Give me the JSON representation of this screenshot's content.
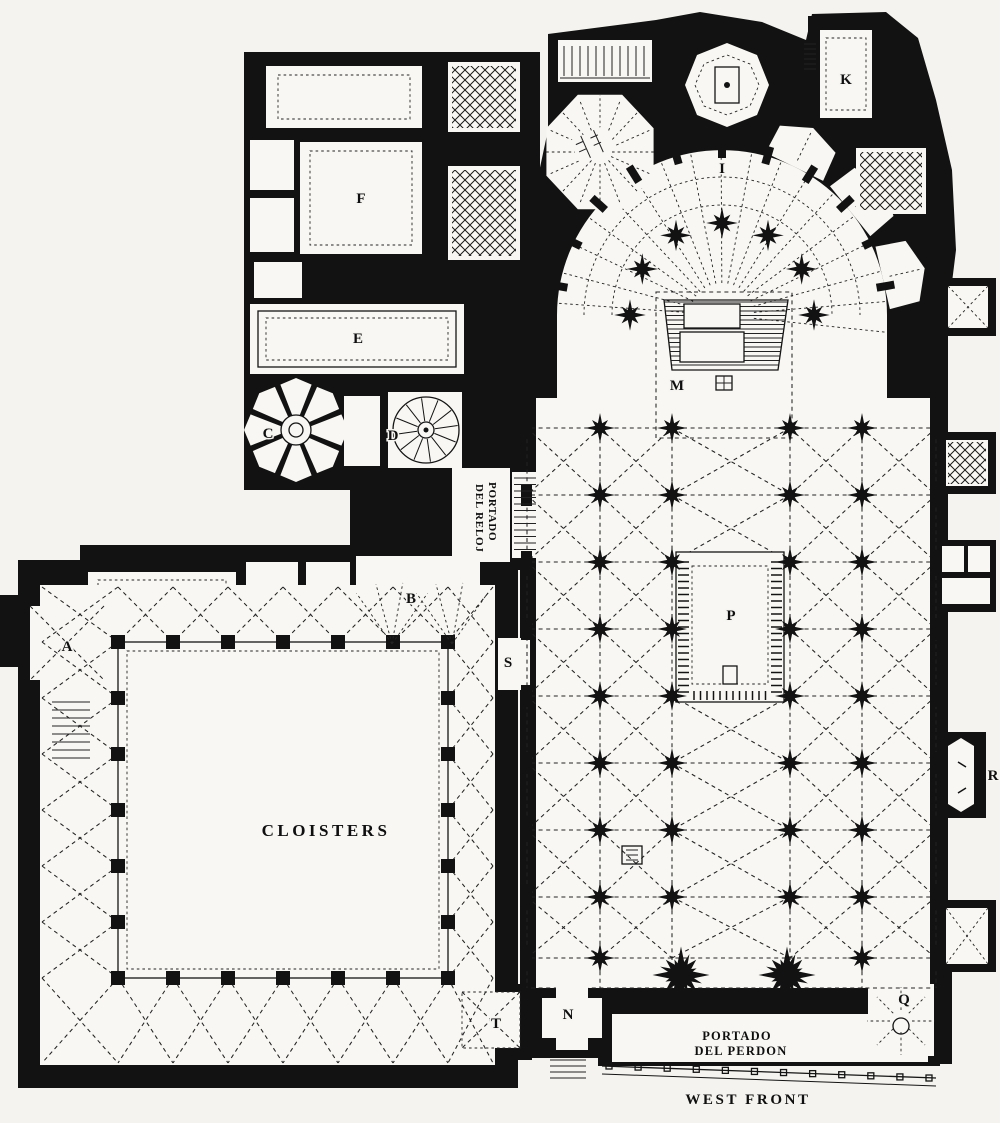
{
  "plan": {
    "description": "Black-ink engraved ground plan of a Gothic cathedral with cloister",
    "colors": {
      "ink": "#121212",
      "paper": "#f4f3ef"
    },
    "labels": {
      "cloisters": "CLOISTERS",
      "portado_del_reloj_1": "PORTADO",
      "portado_del_reloj_2": "DEL RELOJ",
      "portado_del_perdon_1": "PORTADO",
      "portado_del_perdon_2": "DEL PERDON",
      "west_front": "WEST FRONT"
    },
    "letters": {
      "a": "A",
      "b": "B",
      "c": "C",
      "d": "D",
      "e": "E",
      "f": "F",
      "i": "I",
      "k": "K",
      "m": "M",
      "n": "N",
      "p": "P",
      "q": "Q",
      "r": "R",
      "s": "S",
      "t": "T"
    }
  }
}
